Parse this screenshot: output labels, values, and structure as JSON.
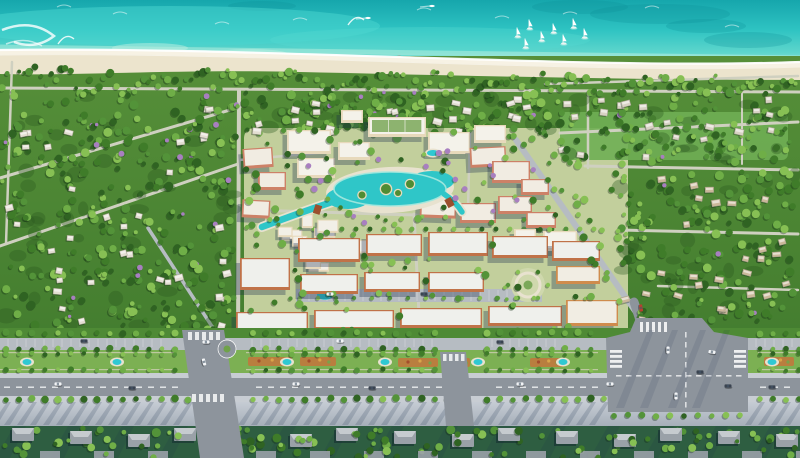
{
  "scene": {
    "name": "coastal-resort-masterplan-aerial-render",
    "width": 800,
    "height": 458,
    "description": "Aerial 3D rendering of a beachfront township: turquoise sea with sailboats, white sand beach, forested villa districts, a central resort core with lagoon pool, terracotta mid-rise blocks and a tree-lined boulevard with landscaped medians and a large road intersection."
  },
  "palette": {
    "oceanDeep": "#16a6ac",
    "oceanMid": "#2ec3c2",
    "oceanLight": "#5ed6cc",
    "oceanShore": "#9fe8d8",
    "sand": "#ece4cd",
    "sandWet": "#f9f5e8",
    "landDark": "#3c762b",
    "landMid": "#568f39",
    "lawn": "#7cb053",
    "fieldGreen": "#6fae54",
    "vegBase": "#4e8a35",
    "roadPale": "#cfd0c0",
    "roadLight": "#b6bcc2",
    "roadMid": "#979ea6",
    "asphalt": "#8d949c",
    "sidewalk": "#c8cdd3",
    "promTop": "#c6ccd4",
    "promBottom": "#a6afb9",
    "creamWall": "#e7d9bb",
    "creamRoof": "#f4f2ea",
    "salmonWall": "#cd8167",
    "salmonRoof": "#f1ece2",
    "terraWall": "#c07248",
    "terraRoof": "#eff0ec",
    "orangeWall": "#cf8c4d",
    "orangeRoof": "#f1ede3",
    "lagoon": "#2fc6c8",
    "lagoonRim": "#a5e8de",
    "pool": "#2fc8d2",
    "poolDeck": "#e8e2cf",
    "bridge": "#9b4f2e",
    "purpleTree": "#a87fc0",
    "shadow": "rgba(25,45,75,0.32)",
    "carWhite": "#f2f4f6",
    "carDark": "#3a4350",
    "carRed": "#b8402f",
    "grayRoof": "#9aa1a8",
    "grayRoofLight": "#c6cbcf",
    "bottomGround": "#2e5e41"
  },
  "ocean": {
    "dark_patches": [
      [
        660,
        14,
        70,
        10
      ],
      [
        748,
        40,
        44,
        8
      ],
      [
        580,
        7,
        48,
        7
      ],
      [
        262,
        6,
        34,
        5
      ],
      [
        706,
        26,
        40,
        7
      ]
    ],
    "crest_arcs": [
      [
        120,
        14
      ],
      [
        222,
        24
      ],
      [
        424,
        10
      ],
      [
        502,
        18
      ],
      [
        652,
        8
      ],
      [
        732,
        27
      ],
      [
        64,
        7
      ],
      [
        300,
        20
      ],
      [
        570,
        14
      ]
    ],
    "kite_trails": [
      [
        58,
        44
      ],
      [
        348,
        25
      ]
    ],
    "motorboats": [
      [
        432,
        6
      ],
      [
        368,
        18
      ]
    ],
    "sailboats": [
      [
        517,
        36
      ],
      [
        529,
        28
      ],
      [
        541,
        40
      ],
      [
        553,
        32
      ],
      [
        563,
        43
      ],
      [
        573,
        27
      ],
      [
        584,
        37
      ],
      [
        525,
        47
      ]
    ],
    "pier": [
      377,
      66,
      399,
      57
    ],
    "sandbars": [
      [
        150,
        48
      ],
      [
        250,
        54
      ]
    ]
  },
  "roads": [
    [
      0,
      88,
      800,
      92,
      3,
      "roadPale"
    ],
    [
      12,
      62,
      6,
      244,
      2.5,
      "roadPale"
    ],
    [
      0,
      178,
      240,
      107,
      3,
      "roadPale"
    ],
    [
      0,
      246,
      238,
      164,
      3,
      "roadPale"
    ],
    [
      226,
      348,
      148,
      228,
      3.5,
      "roadLight"
    ],
    [
      239,
      90,
      238,
      346,
      4,
      "roadPale"
    ],
    [
      239,
      160,
      330,
      152,
      2.5,
      "roadPale"
    ],
    [
      545,
      84,
      798,
      76,
      2.5,
      "roadPale"
    ],
    [
      560,
      133,
      798,
      122,
      3,
      "roadPale"
    ],
    [
      588,
      92,
      588,
      168,
      2.5,
      "roadPale"
    ],
    [
      585,
      166,
      798,
      170,
      3,
      "roadPale"
    ],
    [
      620,
      230,
      798,
      234,
      3,
      "roadPale"
    ],
    [
      658,
      286,
      798,
      290,
      2.5,
      "roadPale"
    ],
    [
      742,
      92,
      742,
      164,
      2,
      "roadPale"
    ],
    [
      516,
      140,
      640,
      318,
      6,
      "roadLight"
    ],
    [
      250,
      210,
      416,
      215,
      3,
      "roadPale"
    ],
    [
      414,
      214,
      420,
      334,
      3,
      "roadPale"
    ],
    [
      470,
      132,
      468,
      208,
      2.5,
      "roadPale"
    ],
    [
      634,
      302,
      642,
      326,
      9,
      "asphalt"
    ]
  ],
  "forest_regions": [
    {
      "name": "west-villa-forest",
      "x": 2,
      "y": 94,
      "w": 232,
      "h": 242,
      "trees": 300,
      "villas": 36,
      "seed": 11,
      "roof": "#e3ded2"
    },
    {
      "name": "north-villa-strip",
      "x": 234,
      "y": 94,
      "w": 330,
      "h": 44,
      "trees": 150,
      "villas": 24,
      "seed": 88,
      "roof": "#e3ded2"
    },
    {
      "name": "east-villa-forest",
      "x": 618,
      "y": 170,
      "w": 178,
      "h": 156,
      "trees": 150,
      "villas": 28,
      "seed": 22,
      "roof": "#cbb89a"
    },
    {
      "name": "coastal-villas",
      "x": 545,
      "y": 92,
      "w": 250,
      "h": 72,
      "trees": 95,
      "villas": 20,
      "seed": 33,
      "roof": "#d8d2c4"
    },
    {
      "name": "south-villa-fringe",
      "x": 2,
      "y": 424,
      "w": 796,
      "h": 32,
      "trees": 120,
      "villas": 0,
      "seed": 44,
      "skipx": [
        196,
        252
      ]
    }
  ],
  "coastal_band": {
    "seed": 55
  },
  "core": {
    "x": 244,
    "y": 128,
    "w": 384,
    "h": 210,
    "ground": "#c2cf9c",
    "trees": 150,
    "purple": 16,
    "seed": 66,
    "beige_cluster": {
      "x": 272,
      "y": 214,
      "w": 118,
      "h": 58,
      "n": 12,
      "seed": 77
    },
    "garden_circle": [
      528,
      285,
      17
    ],
    "parking": {
      "x": 296,
      "y": 289,
      "w": 246,
      "h": 13,
      "pool": [
        325,
        292,
        10,
        6
      ]
    },
    "field": {
      "x": 560,
      "y": 112,
      "w": 228,
      "h": 48
    }
  },
  "lagoon": {
    "cx": 390,
    "cy": 189,
    "blobs": [
      [
        390,
        189,
        56,
        17
      ],
      [
        348,
        198,
        22,
        11
      ],
      [
        432,
        181,
        22,
        10
      ]
    ],
    "islands": [
      [
        386,
        189,
        5
      ],
      [
        410,
        184,
        4
      ],
      [
        362,
        195,
        3.5
      ],
      [
        398,
        193,
        3
      ]
    ],
    "canal_west": "M332,202 Q296,214 262,227",
    "canal_east": "M444,194 Q456,202 462,212",
    "bridges": [
      [
        314,
        205,
        18
      ],
      [
        446,
        198,
        -28
      ]
    ]
  },
  "buildings": [
    [
      287,
      130,
      44,
      24,
      "cream",
      0
    ],
    [
      297,
      158,
      38,
      20,
      "cream",
      0
    ],
    [
      338,
      142,
      32,
      18,
      "cream",
      0
    ],
    [
      243,
      148,
      30,
      20,
      "salmon",
      -4
    ],
    [
      258,
      172,
      28,
      18,
      "salmon",
      0
    ],
    [
      242,
      200,
      28,
      18,
      "salmon",
      3
    ],
    [
      368,
      117,
      58,
      20,
      "cream",
      0,
      "g"
    ],
    [
      341,
      110,
      22,
      13,
      "cream",
      0
    ],
    [
      428,
      132,
      42,
      22,
      "cream",
      0
    ],
    [
      474,
      125,
      32,
      18,
      "cream",
      0
    ],
    [
      470,
      147,
      36,
      20,
      "salmon",
      -3
    ],
    [
      492,
      161,
      38,
      22,
      "salmon",
      0
    ],
    [
      521,
      179,
      28,
      16,
      "salmon",
      0
    ],
    [
      420,
      198,
      36,
      20,
      "salmon",
      2
    ],
    [
      460,
      203,
      36,
      20,
      "salmon",
      0
    ],
    [
      498,
      196,
      34,
      18,
      "salmon",
      0
    ],
    [
      526,
      212,
      30,
      16,
      "salmon",
      0
    ],
    [
      543,
      231,
      34,
      20,
      "cream",
      0
    ],
    [
      514,
      229,
      22,
      13,
      "cream",
      0
    ],
    [
      298,
      238,
      62,
      24,
      "terra",
      0
    ],
    [
      366,
      234,
      56,
      22,
      "terra",
      0
    ],
    [
      428,
      232,
      60,
      24,
      "terra",
      0
    ],
    [
      492,
      236,
      56,
      22,
      "terra",
      0
    ],
    [
      552,
      241,
      48,
      20,
      "terra",
      0
    ],
    [
      240,
      258,
      50,
      32,
      "terra",
      0
    ],
    [
      300,
      274,
      58,
      20,
      "terra",
      0
    ],
    [
      364,
      272,
      56,
      20,
      "terra",
      0
    ],
    [
      428,
      272,
      56,
      20,
      "terra",
      0
    ],
    [
      556,
      266,
      44,
      18,
      "orange",
      0
    ],
    [
      236,
      312,
      72,
      20,
      "terra",
      0
    ],
    [
      314,
      310,
      80,
      20,
      "terra",
      0
    ],
    [
      400,
      308,
      82,
      20,
      "terra",
      0
    ],
    [
      488,
      306,
      74,
      20,
      "terra",
      0
    ],
    [
      566,
      300,
      52,
      26,
      "orange",
      0
    ]
  ],
  "building_pools": [
    [
      433,
      153,
      6,
      3
    ]
  ],
  "boulevard": {
    "pools_x": [
      27,
      117,
      287,
      385,
      478,
      563,
      772
    ],
    "pool_y": 362,
    "flower_beds": [
      [
        248,
        357,
        44,
        9
      ],
      [
        300,
        357,
        36,
        9
      ],
      [
        398,
        358,
        40,
        9
      ],
      [
        452,
        358,
        18,
        9
      ],
      [
        530,
        358,
        34,
        9
      ],
      [
        764,
        357,
        30,
        9
      ]
    ],
    "median_segments": [
      [
        0,
        176
      ],
      [
        246,
        436
      ],
      [
        486,
        598
      ],
      [
        758,
        800
      ]
    ],
    "stall_groups": [
      [
        8,
        170
      ],
      [
        252,
        436
      ],
      [
        492,
        560
      ],
      [
        756,
        796
      ]
    ],
    "crossing_west": "182,330 224,330 244,458 200,458",
    "crossing_mid": "440,352 466,352 474,426 446,426",
    "intersection": "636,318 702,318 714,332 748,338 748,412 608,412 606,338 630,332",
    "roundabout": [
      227,
      349,
      9
    ]
  },
  "cars": [
    [
      58,
      384,
      "white",
      0
    ],
    [
      132,
      388,
      "dark",
      0
    ],
    [
      296,
      384,
      "white",
      0
    ],
    [
      372,
      388,
      "dark",
      0
    ],
    [
      520,
      384,
      "white",
      0
    ],
    [
      772,
      387,
      "dark",
      0
    ],
    [
      84,
      341,
      "dark",
      0
    ],
    [
      206,
      342,
      "white",
      0
    ],
    [
      340,
      341,
      "white",
      0
    ],
    [
      500,
      342,
      "dark",
      0
    ],
    [
      712,
      352,
      "white",
      8
    ],
    [
      668,
      350,
      "white",
      90
    ],
    [
      700,
      372,
      "dark",
      0
    ],
    [
      676,
      396,
      "white",
      90
    ],
    [
      728,
      386,
      "dark",
      0
    ],
    [
      641,
      308,
      "red",
      80
    ],
    [
      330,
      294,
      "white",
      0
    ],
    [
      424,
      294,
      "dark",
      0
    ],
    [
      610,
      384,
      "white",
      0
    ],
    [
      204,
      362,
      "white",
      75
    ]
  ],
  "bottom_row": {
    "y": 430,
    "start": 12,
    "step": 54,
    "count": 15,
    "skipx": [
      196,
      252
    ]
  }
}
